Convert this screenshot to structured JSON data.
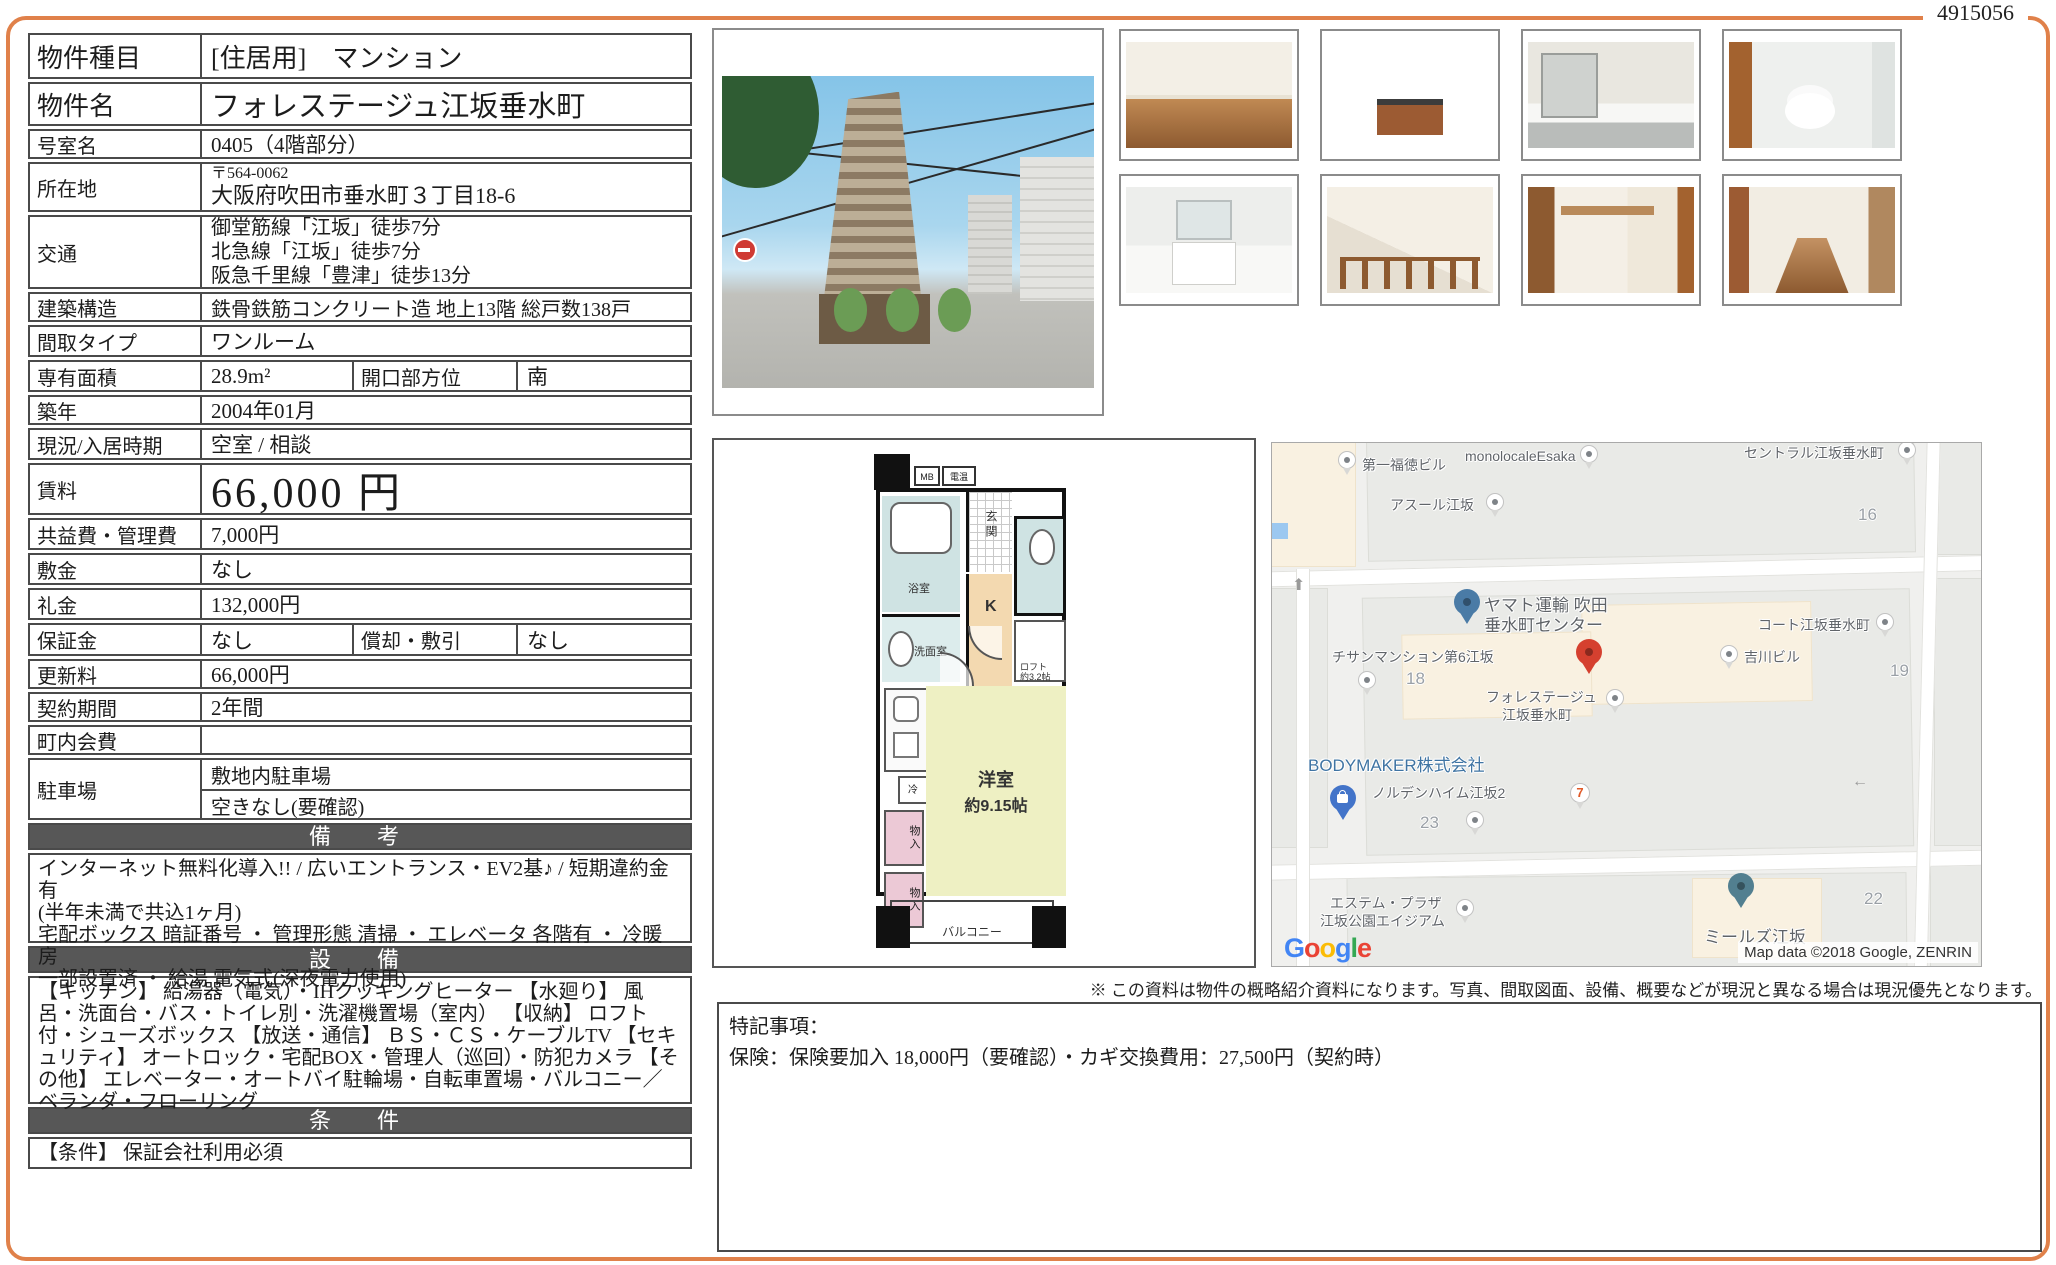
{
  "doc_number": "4915056",
  "colors": {
    "accent_orange": "#e0814a",
    "section_header_bg": "#575757",
    "table_border": "#4a4a4a",
    "plan_room": "#eef0c3",
    "plan_bath": "#cfe3e3",
    "plan_kitchen": "#f3d9b0",
    "plan_closet": "#ecc9d6",
    "map_pin_red": "#d5402f",
    "map_pin_blue": "#4a7ba6"
  },
  "table": {
    "rows": [
      {
        "label": "物件種目",
        "value": "[住居用]　マンション"
      },
      {
        "label": "物件名",
        "value": "フォレステージュ江坂垂水町"
      },
      {
        "label": "号室名",
        "value": "0405（4階部分）"
      },
      {
        "label": "所在地",
        "postal": "〒564-0062",
        "value": "大阪府吹田市垂水町３丁目18-6"
      },
      {
        "label": "交通",
        "lines": [
          "御堂筋線「江坂」徒歩7分",
          "北急線「江坂」徒歩7分",
          "阪急千里線「豊津」徒歩13分"
        ]
      },
      {
        "label": "建築構造",
        "value": "鉄骨鉄筋コンクリート造 地上13階 総戸数138戸"
      },
      {
        "label": "間取タイプ",
        "value": "ワンルーム"
      },
      {
        "label": "専有面積",
        "value": "28.9m²",
        "label2": "開口部方位",
        "value2": "南"
      },
      {
        "label": "築年",
        "value": "2004年01月"
      },
      {
        "label": "現況/入居時期",
        "value": "空室 / 相談"
      },
      {
        "label": "賃料",
        "value": "66,000 円"
      },
      {
        "label": "共益費・管理費",
        "value": "7,000円"
      },
      {
        "label": "敷金",
        "value": "なし"
      },
      {
        "label": "礼金",
        "value": "132,000円"
      },
      {
        "label": "保証金",
        "value": "なし",
        "label2": "償却・敷引",
        "value2": "なし"
      },
      {
        "label": "更新料",
        "value": "66,000円"
      },
      {
        "label": "契約期間",
        "value": "2年間"
      },
      {
        "label": "町内会費",
        "value": ""
      },
      {
        "label": "駐車場",
        "value": "敷地内駐車場",
        "value2": "空きなし(要確認)"
      }
    ],
    "sections": {
      "biko": {
        "title": "備　考",
        "lines": [
          "インターネット無料化導入!!  /  広いエントランス・EV2基♪  /  短期違約金有",
          "(半年未満で共込1ヶ月)",
          "宅配ボックス 暗証番号 ・ 管理形態 清掃 ・ エレベータ 各階有 ・ 冷暖房",
          "一部設置済 ・ 給湯 電気式(深夜電力使用)"
        ]
      },
      "equip": {
        "title": "設　備",
        "text": "【キッチン】 給湯器（電気）・IHクッキングヒーター 【水廻り】 風呂・洗面台・バス・トイレ別・洗濯機置場（室内） 【収納】 ロフト付・シューズボックス 【放送・通信】 ＢＳ・ＣＳ・ケーブルTV 【セキュリティ】 オートロック・宅配BOX・管理人（巡回）・防犯カメラ 【その他】 エレベーター・オートバイ駐輪場・自転車置場・バルコニー／ベランダ・フローリング"
      },
      "cond": {
        "title": "条　件",
        "text": "【条件】 保証会社利用必須"
      }
    }
  },
  "floor_plan": {
    "mb": "MB",
    "meter": "電温",
    "genkan": "玄関",
    "bath": "浴室",
    "wash_room": "洗面室",
    "kitchen": "K",
    "loft_l1": "ロフト",
    "loft_l2": "約3.2帖",
    "fridge": "冷",
    "closet1": "物入",
    "closet2": "物入",
    "room_l1": "洋室",
    "room_l2": "約9.15帖",
    "balcony": "バルコニー"
  },
  "map": {
    "places": {
      "fukutoku": "第一福徳ビル",
      "monolocale": "monolocaleEsaka",
      "azur": "アスール江坂",
      "central": "セントラル江坂垂水町",
      "yamato_l1": "ヤマト運輸 吹田",
      "yamato_l2": "垂水町センター",
      "chisan": "チサンマンション第6江坂",
      "forestage_l1": "フォレステージュ",
      "forestage_l2": "江坂垂水町",
      "court": "コート江坂垂水町",
      "yoshikawa": "吉川ビル",
      "bodymaker": "BODYMAKER株式会社",
      "norden": "ノルデンハイム江坂2",
      "estem_l1": "エステム・プラザ",
      "estem_l2": "江坂公園エイジアム",
      "meals": "ミールズ江坂",
      "seven": "7"
    },
    "numbers": {
      "n16": "16",
      "n18": "18",
      "n19": "19",
      "n22": "22",
      "n23": "23"
    },
    "google_logo": [
      "G",
      "o",
      "o",
      "g",
      "l",
      "e"
    ],
    "attribution": "Map data ©2018 Google, ZENRIN"
  },
  "bottom": {
    "disclaimer": "※ この資料は物件の概略紹介資料になります。写真、間取図面、設備、概要などが現況と異なる場合は現況優先となります。",
    "tokki_title": "特記事項：",
    "tokki_body": "保険：保険要加入 18,000円（要確認）・カギ交換費用：27,500円（契約時）"
  }
}
